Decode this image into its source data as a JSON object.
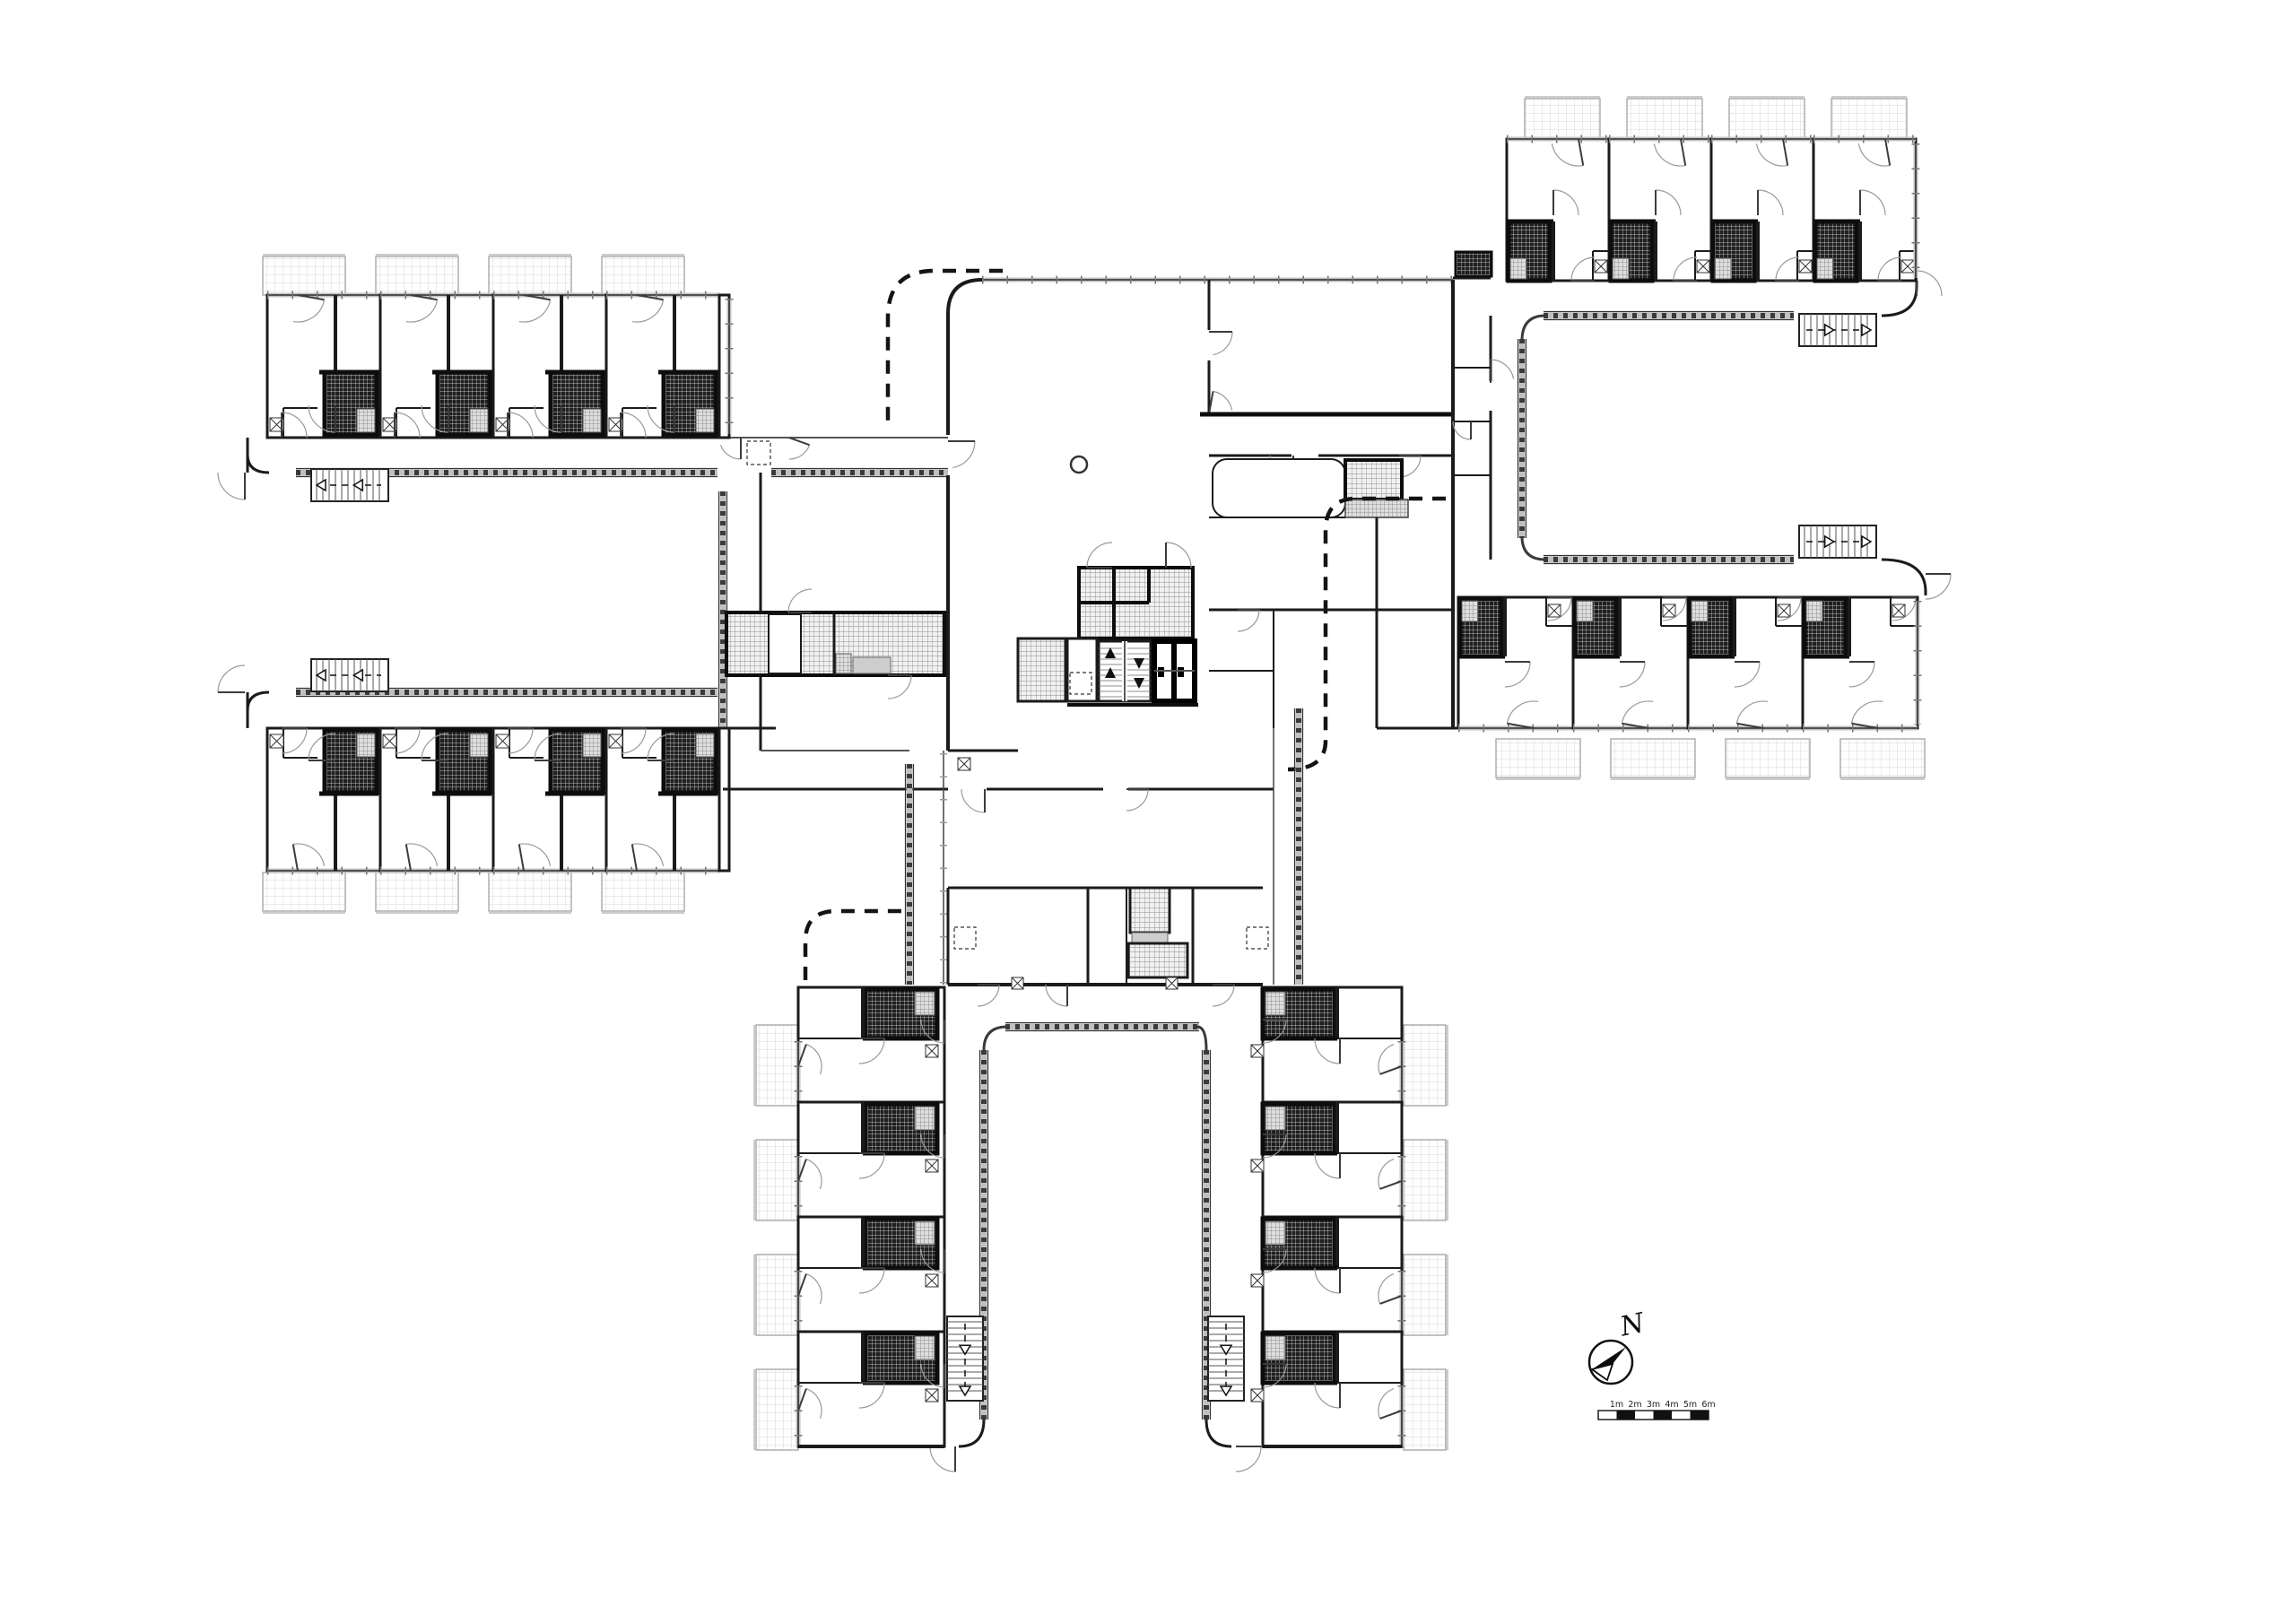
{
  "document": {
    "type": "architectural-floor-plan",
    "sheet": "residential upper floor plan",
    "visible_text_labels": [
      "N",
      "1m",
      "2m",
      "3m",
      "4m",
      "5m",
      "6m"
    ]
  },
  "compass": {
    "label": "N"
  },
  "scale_bar": {
    "labels": [
      "1m",
      "2m",
      "3m",
      "4m",
      "5m",
      "6m"
    ],
    "segment_count": 6,
    "start_fill": "white",
    "alternate_fill": "black"
  },
  "colors": {
    "background": "#ffffff",
    "wall": "#1b1b1b",
    "wall_heavy": "#0d0d0d",
    "bath_fill": "#1f1f1f",
    "bath_grid": "#e8e8e8",
    "tile_fill": "#f1f1f1",
    "tile_grid": "#8c8c8c",
    "balcony_grid": "#d9d9d9",
    "balcony_edge": "#a9a9a9",
    "shower_fill": "#dedede",
    "shower_grid": "#7a7a7a",
    "door_arc": "#9a9a9a",
    "door_leaf": "#3c3c3c",
    "balustrade": "#3a3a3a",
    "balustrade_base": "#c0c0c0",
    "window_band": "#c2c2c2",
    "canopy_dash": "#141414",
    "gray_fixture": "#cdcdcd",
    "scale_black": "#111111"
  },
  "wings": {
    "top_left": {
      "label": "west block",
      "courtyard": "opens west",
      "unit_count_top": 4,
      "unit_count_bottom": 4,
      "balcony_count": 8,
      "stair_count": 2
    },
    "top_right": {
      "label": "east block",
      "courtyard": "opens east",
      "unit_count_top": 4,
      "unit_count_bottom": 4,
      "balcony_count": 8,
      "stair_count": 2
    },
    "bottom": {
      "label": "south block",
      "courtyard": "opens south",
      "unit_count_left": 4,
      "unit_count_right": 4,
      "balcony_count": 8,
      "stair_count": 2
    }
  },
  "core": {
    "elevator_count": 2,
    "stair_count": 1,
    "tiled_room_count": 5,
    "column_count": 1
  }
}
